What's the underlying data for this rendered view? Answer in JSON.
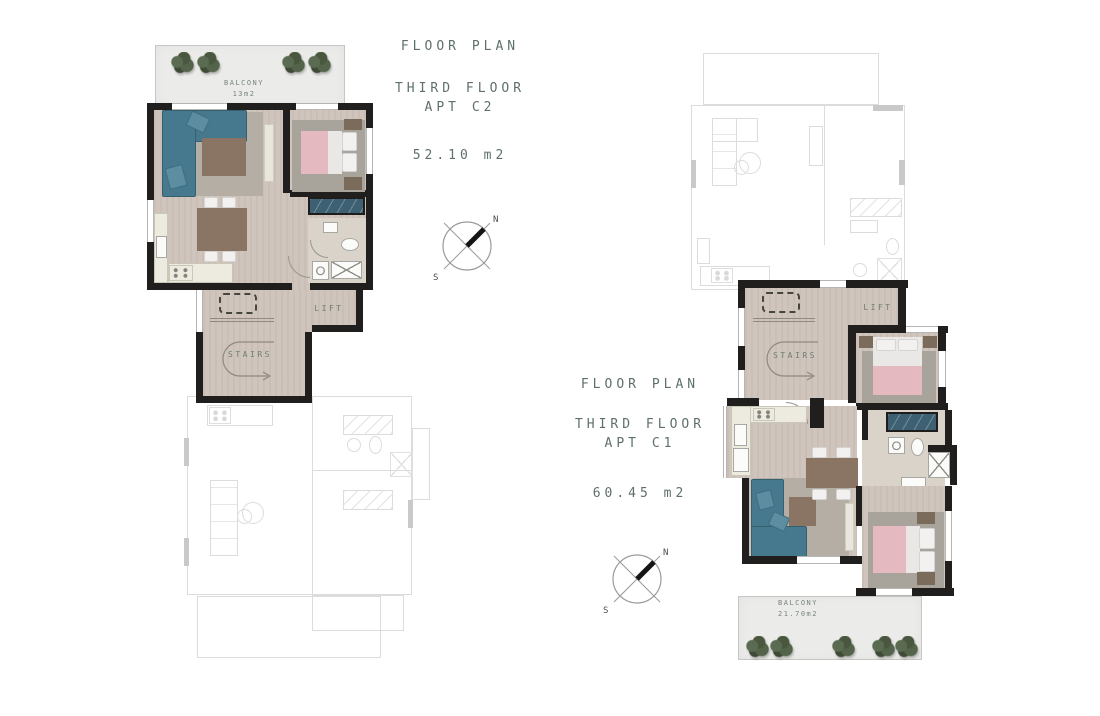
{
  "plans": {
    "c2": {
      "heading": {
        "title": "FLOOR PLAN",
        "floor_line": "THIRD FLOOR",
        "apt_line": "APT C2",
        "area": "52.10 m2"
      },
      "rooms": {
        "balcony": "BALCONY",
        "balcony_area": "13m2",
        "lift": "LIFT",
        "stairs": "STAIRS"
      }
    },
    "c1": {
      "heading": {
        "title": "FLOOR PLAN",
        "floor_line": "THIRD FLOOR",
        "apt_line": "APT C1",
        "area": "60.45 m2"
      },
      "rooms": {
        "balcony": "BALCONY",
        "balcony_area": "21.70m2",
        "lift": "LIFT",
        "stairs": "STAIRS"
      }
    }
  },
  "compass": {
    "north": "N",
    "south": "S"
  },
  "colors": {
    "heading_text": "#5f706c",
    "room_label_text": "#6d7d72",
    "wall": "#211f1d",
    "floor": "#cfc5bc",
    "rug": "#b2aca3",
    "sofa_teal": "#47798e",
    "bed_pink": "#e5b9c0",
    "wood_brown": "#8a7464",
    "closet_blue": "#3d6073",
    "balcony_gray": "#ebebe9",
    "plant_green": "#4d5c44",
    "faded_line": "#dcdcdc"
  }
}
